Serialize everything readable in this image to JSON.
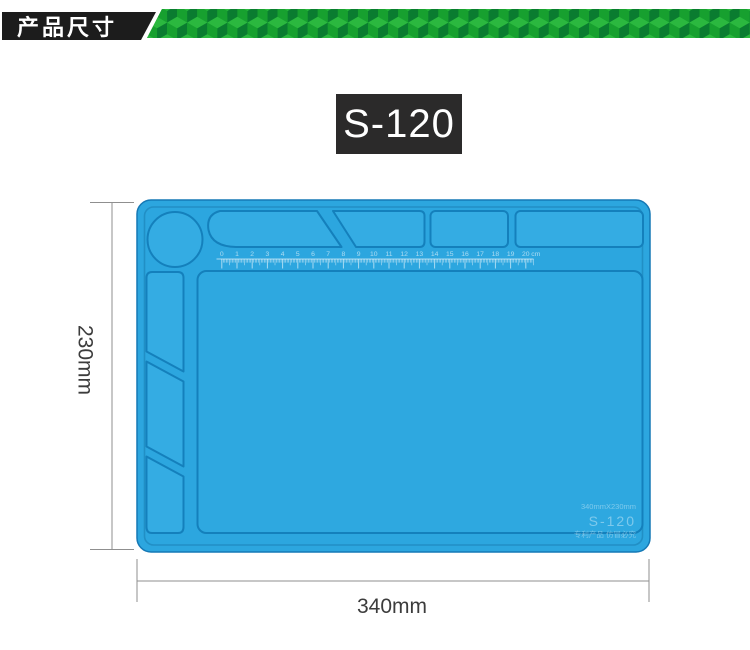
{
  "page": {
    "background": "#ffffff"
  },
  "header": {
    "title": "产品尺寸",
    "colors": {
      "label_bg": "#1c1c1c",
      "label_text": "#ffffff",
      "strip_base": "#1da433",
      "cube_top": "#2bb83f",
      "cube_left": "#17a02f",
      "cube_right": "#0a7c30"
    }
  },
  "model_badge": {
    "label": "S-120",
    "bg": "#2b2a2a",
    "text_color": "#ffffff"
  },
  "mat": {
    "base_color": "#2CA6DF",
    "recess_fill": "#34ACE3",
    "groove_stroke": "#1480BC",
    "outer_stroke": "#1578B5",
    "rim_stroke": "rgba(10,90,140,0.30)",
    "emboss_color": "rgba(255,255,255,0.60)",
    "ruler": {
      "labels": [
        "0",
        "1",
        "2",
        "3",
        "4",
        "5",
        "6",
        "7",
        "8",
        "9",
        "10",
        "11",
        "12",
        "13",
        "14",
        "15",
        "16",
        "17",
        "18",
        "19",
        "20"
      ],
      "unit": "cm"
    },
    "embossed_text": {
      "size_line": "340mmX230mm",
      "model_line": "S-120",
      "notice_line": "专利产品 仿冒必究"
    }
  },
  "dimensions": {
    "height_label": "230mm",
    "width_label": "340mm",
    "line_color": "#8F8F8F",
    "text_color": "#3C3C3C"
  }
}
